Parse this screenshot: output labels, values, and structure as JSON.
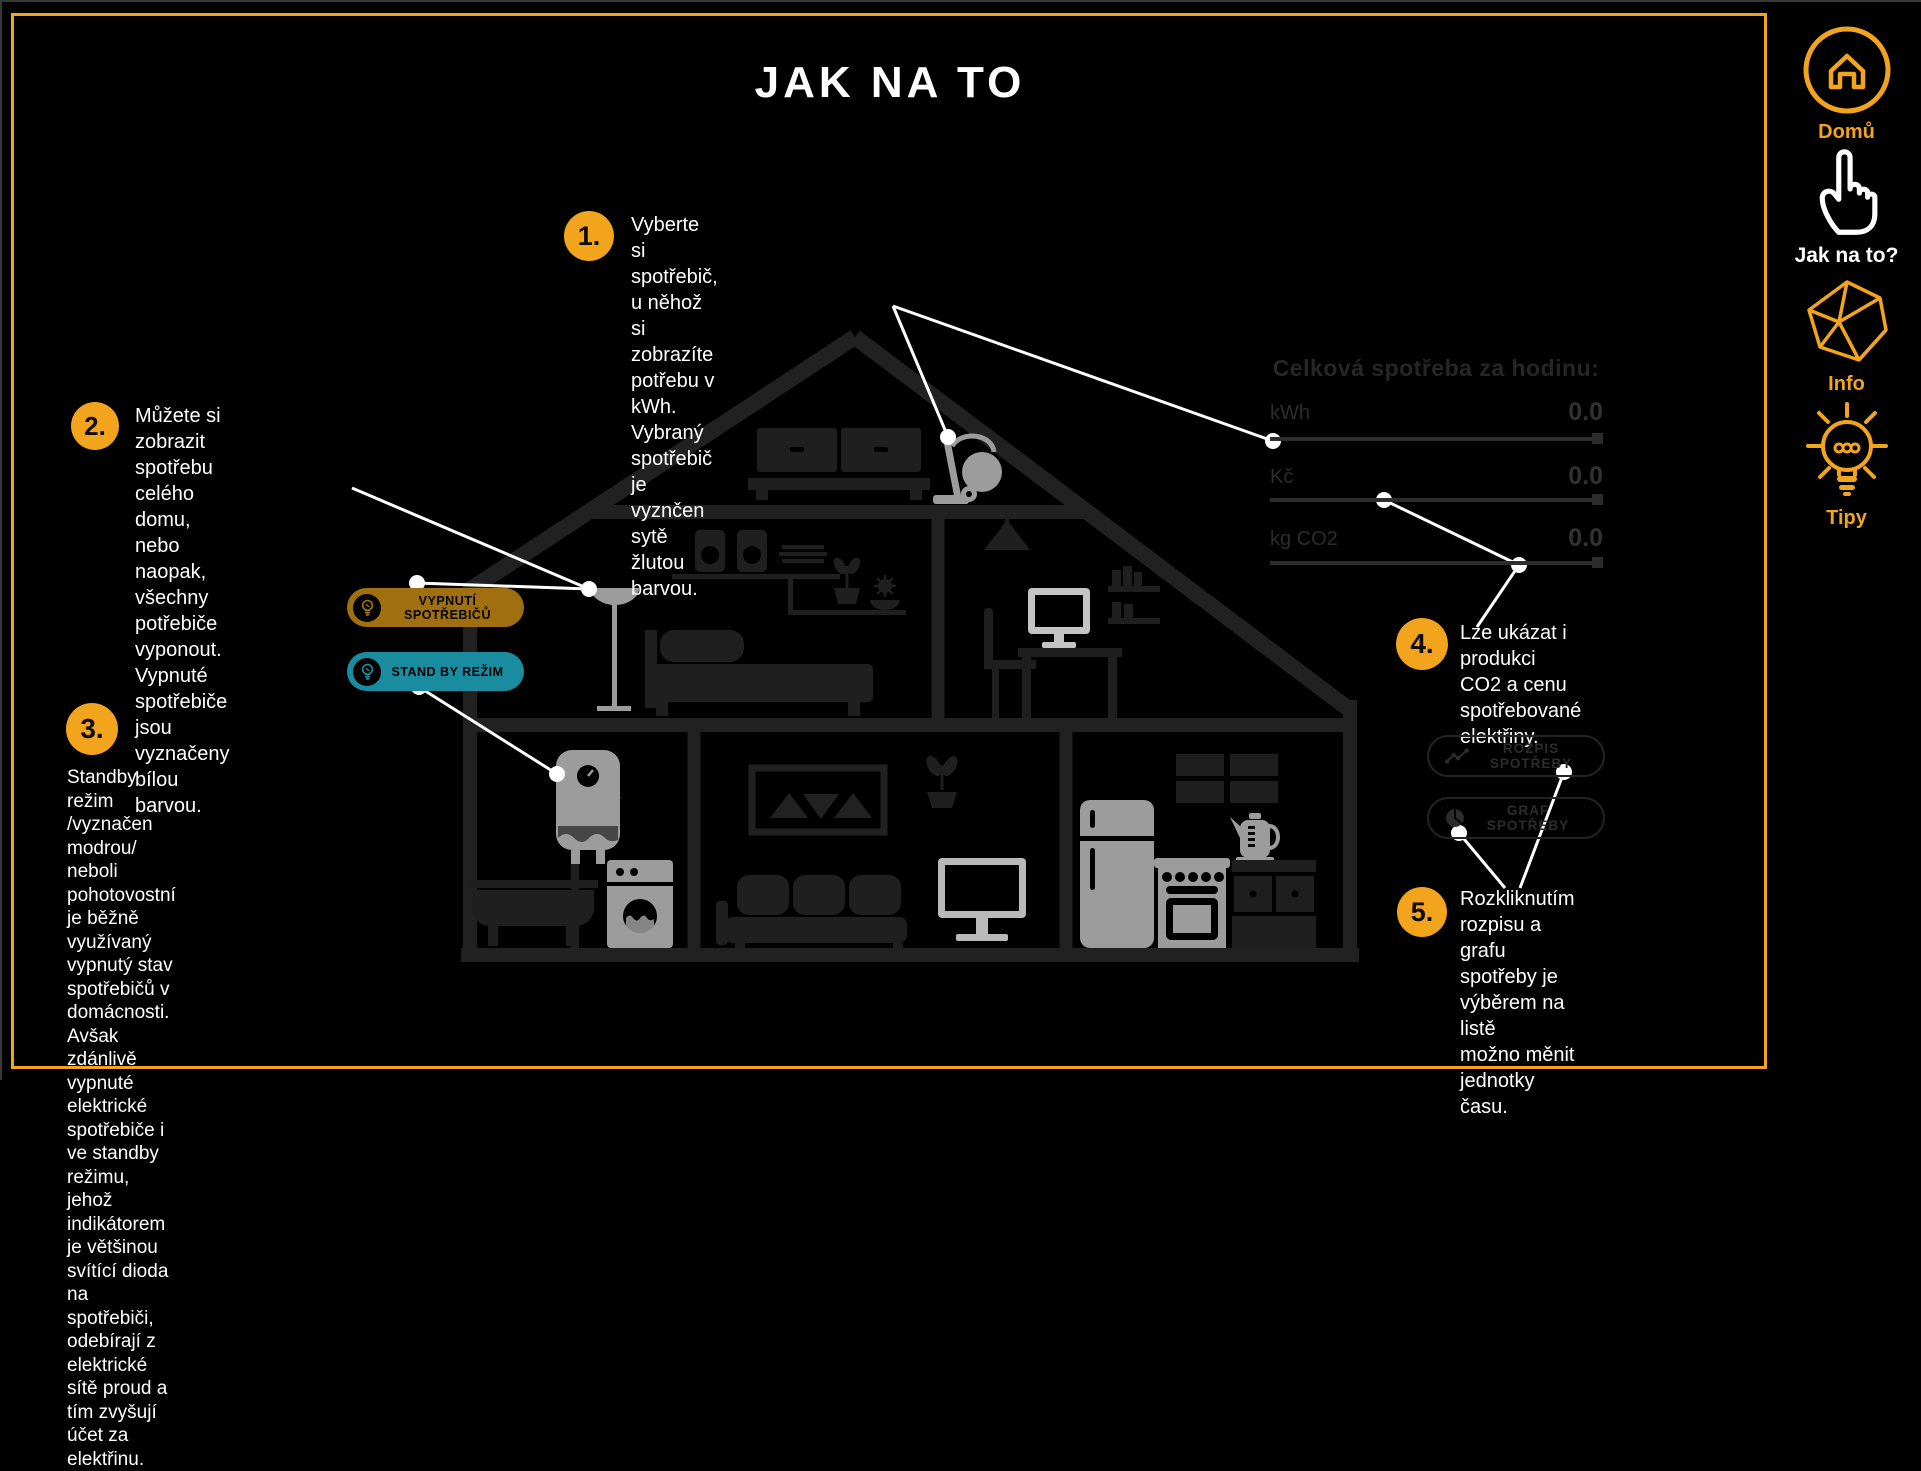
{
  "accent": "#F2A41D",
  "title": "JAK NA TO",
  "steps": [
    {
      "num": "1.",
      "text": "Vyberte si spotřebič, u něhož\nsi zobrazíte potřebu v kWh.\nVybraný spotřebič je vyznčen\nsytě žlutou barvou."
    },
    {
      "num": "2.",
      "text": "Můžete si zobrazit spotřebu\ncelého domu, nebo naopak,\nvšechny potřebiče vyponout.\nVypnuté spotřebiče jsou\nvyznačeny bílou barvou."
    },
    {
      "num": "3.",
      "text": "Standby režim /vyznačen modrou/\nneboli pohotovostní je běžně využívaný\nvypnutý stav spotřebičů v domácnosti.\nAvšak zdánlivě vypnuté elektrické\nspotřebiče i ve standby režimu, jehož\nindikátorem je většinou svítící dioda\nna spotřebiči, odebírají z elektrické\nsítě proud a tím zvyšují účet za elektřinu."
    },
    {
      "num": "4.",
      "text": "Lze ukázat i produkci\nCO2 a cenu spotřebované\nelektřiny."
    },
    {
      "num": "5.",
      "text": "Rozkliknutím rozpisu a grafu\nspotřeby je výběrem na listě\nmožno měnit jednotky času."
    }
  ],
  "toggle_buttons": [
    {
      "label": "VYPNUTÍ SPOTŘEBIČŮ",
      "color": "#A1700E"
    },
    {
      "label": "STAND BY REŽIM",
      "color": "#1A8C9F"
    }
  ],
  "consumption_panel": {
    "title": "Celková spotřeba za hodinu:",
    "rows": [
      {
        "label": "kWh",
        "value": "0.0"
      },
      {
        "label": "Kč",
        "value": "0.0"
      },
      {
        "label": "kg CO2",
        "value": "0.0"
      }
    ]
  },
  "panel_buttons": [
    {
      "label": "ROZPIS SPOTŘEBY",
      "icon": "line-chart-icon"
    },
    {
      "label": "GRAF SPOTŘEBY",
      "icon": "pie-chart-icon"
    }
  ],
  "sidebar": {
    "items": [
      {
        "label": "Domů",
        "icon": "home-icon"
      },
      {
        "label": "Jak na to?",
        "icon": "hand-pointer-icon"
      },
      {
        "label": "Info",
        "icon": "polyhedron-icon"
      },
      {
        "label": "Tipy",
        "icon": "lightbulb-icon"
      }
    ]
  }
}
